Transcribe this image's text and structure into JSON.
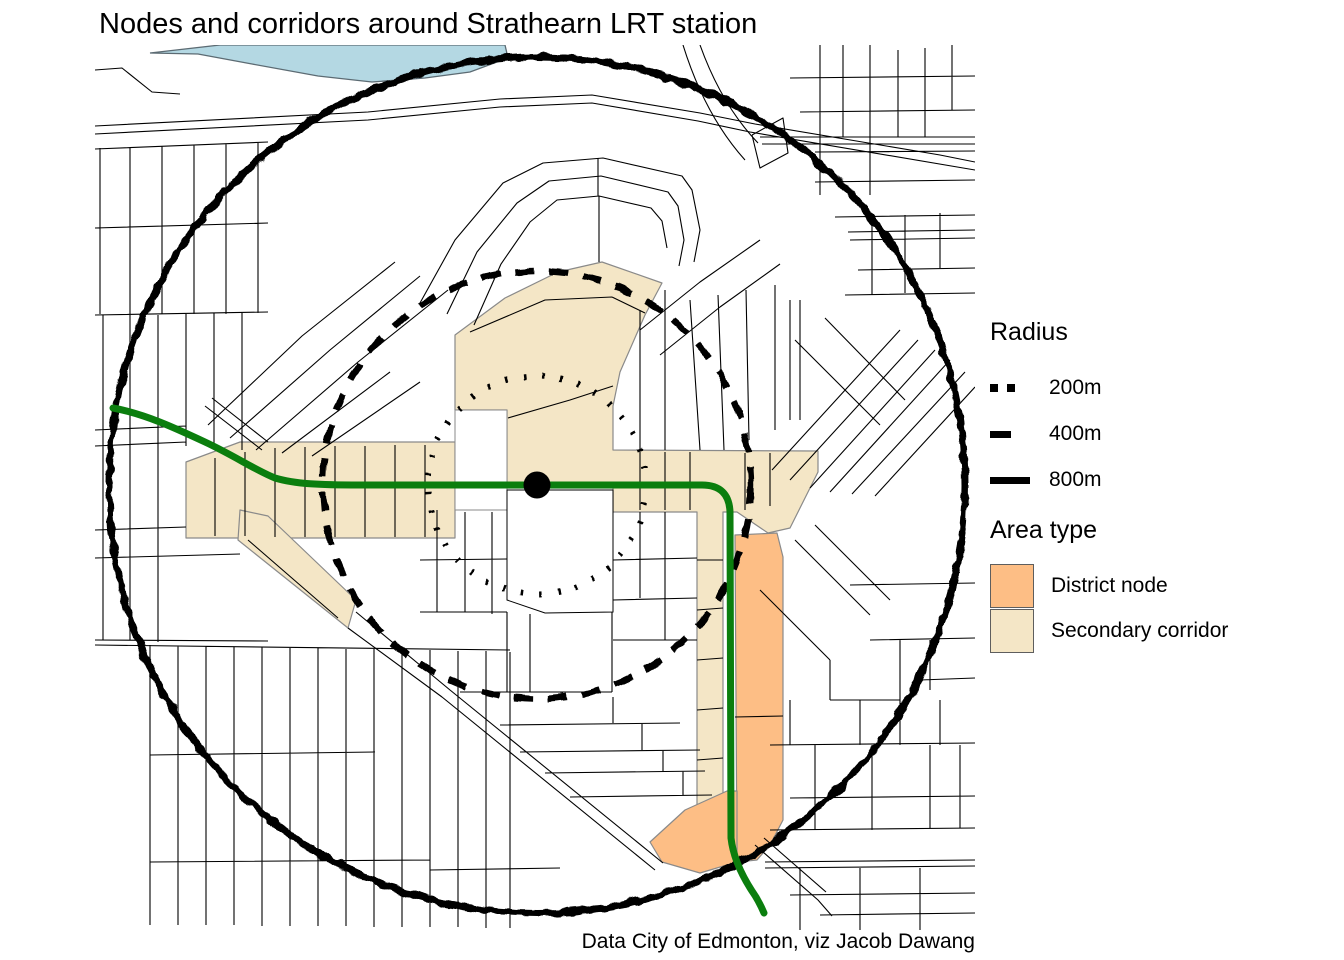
{
  "title": "Nodes and corridors around Strathearn LRT station",
  "caption": "Data City of Edmonton, viz Jacob Dawang",
  "legend_radius": {
    "title": "Radius",
    "items": [
      {
        "label": "200m",
        "style": "dotted"
      },
      {
        "label": "400m",
        "style": "dashed"
      },
      {
        "label": "800m",
        "style": "solid"
      }
    ]
  },
  "legend_area": {
    "title": "Area type",
    "items": [
      {
        "label": "District node",
        "color": "#FDBE85"
      },
      {
        "label": "Secondary corridor",
        "color": "#F4E6C6"
      }
    ]
  },
  "colors": {
    "district_node": "#FDBE85",
    "secondary_corridor": "#F4E6C6",
    "lrt_line": "#0B7E0E",
    "river": "#B4D8E3",
    "radius_rings": "#000000",
    "streets": "#000000",
    "station_marker": "#000000"
  }
}
